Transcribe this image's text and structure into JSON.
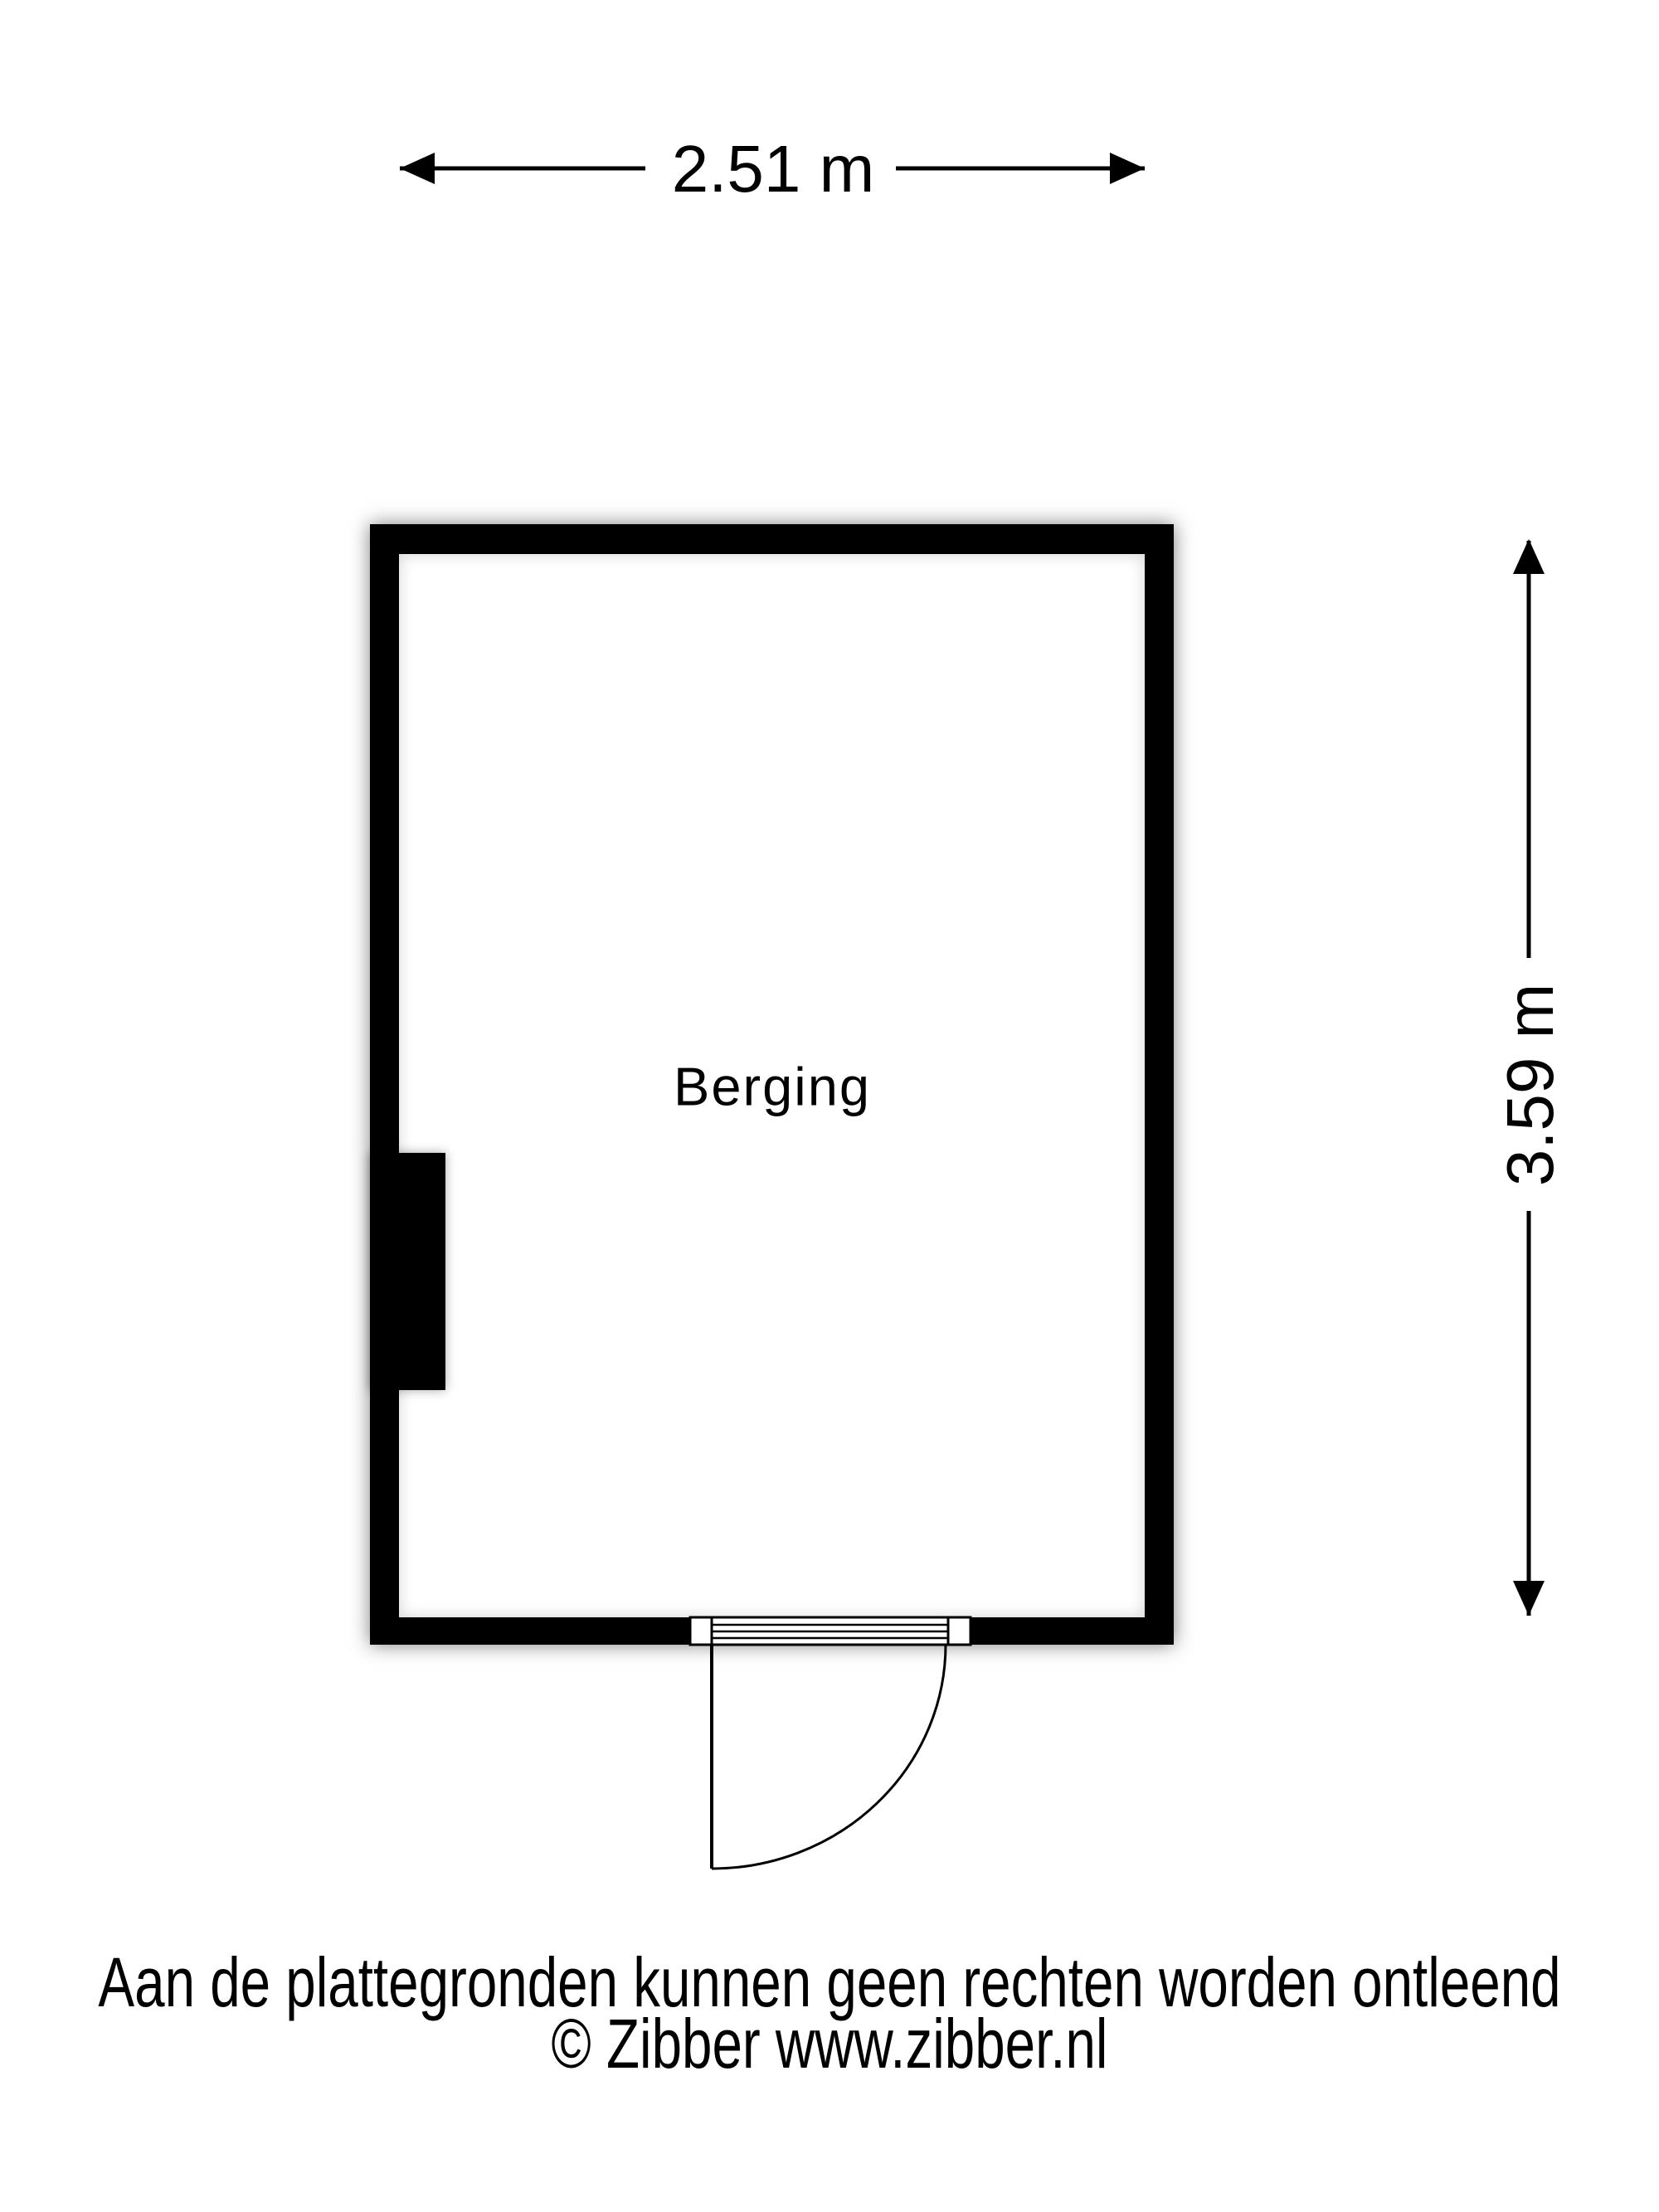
{
  "floorplan": {
    "room": {
      "label": "Berging"
    },
    "dimensions": {
      "width_label": "2.51 m",
      "height_label": "3.59 m"
    },
    "footer": {
      "disclaimer": "Aan de plattegronden kunnen geen rechten worden ontleend",
      "copyright": "© Zibber www.zibber.nl"
    },
    "colors": {
      "wall": "#000000",
      "floor": "#ffffff",
      "background": "#ffffff",
      "line": "#000000"
    }
  }
}
